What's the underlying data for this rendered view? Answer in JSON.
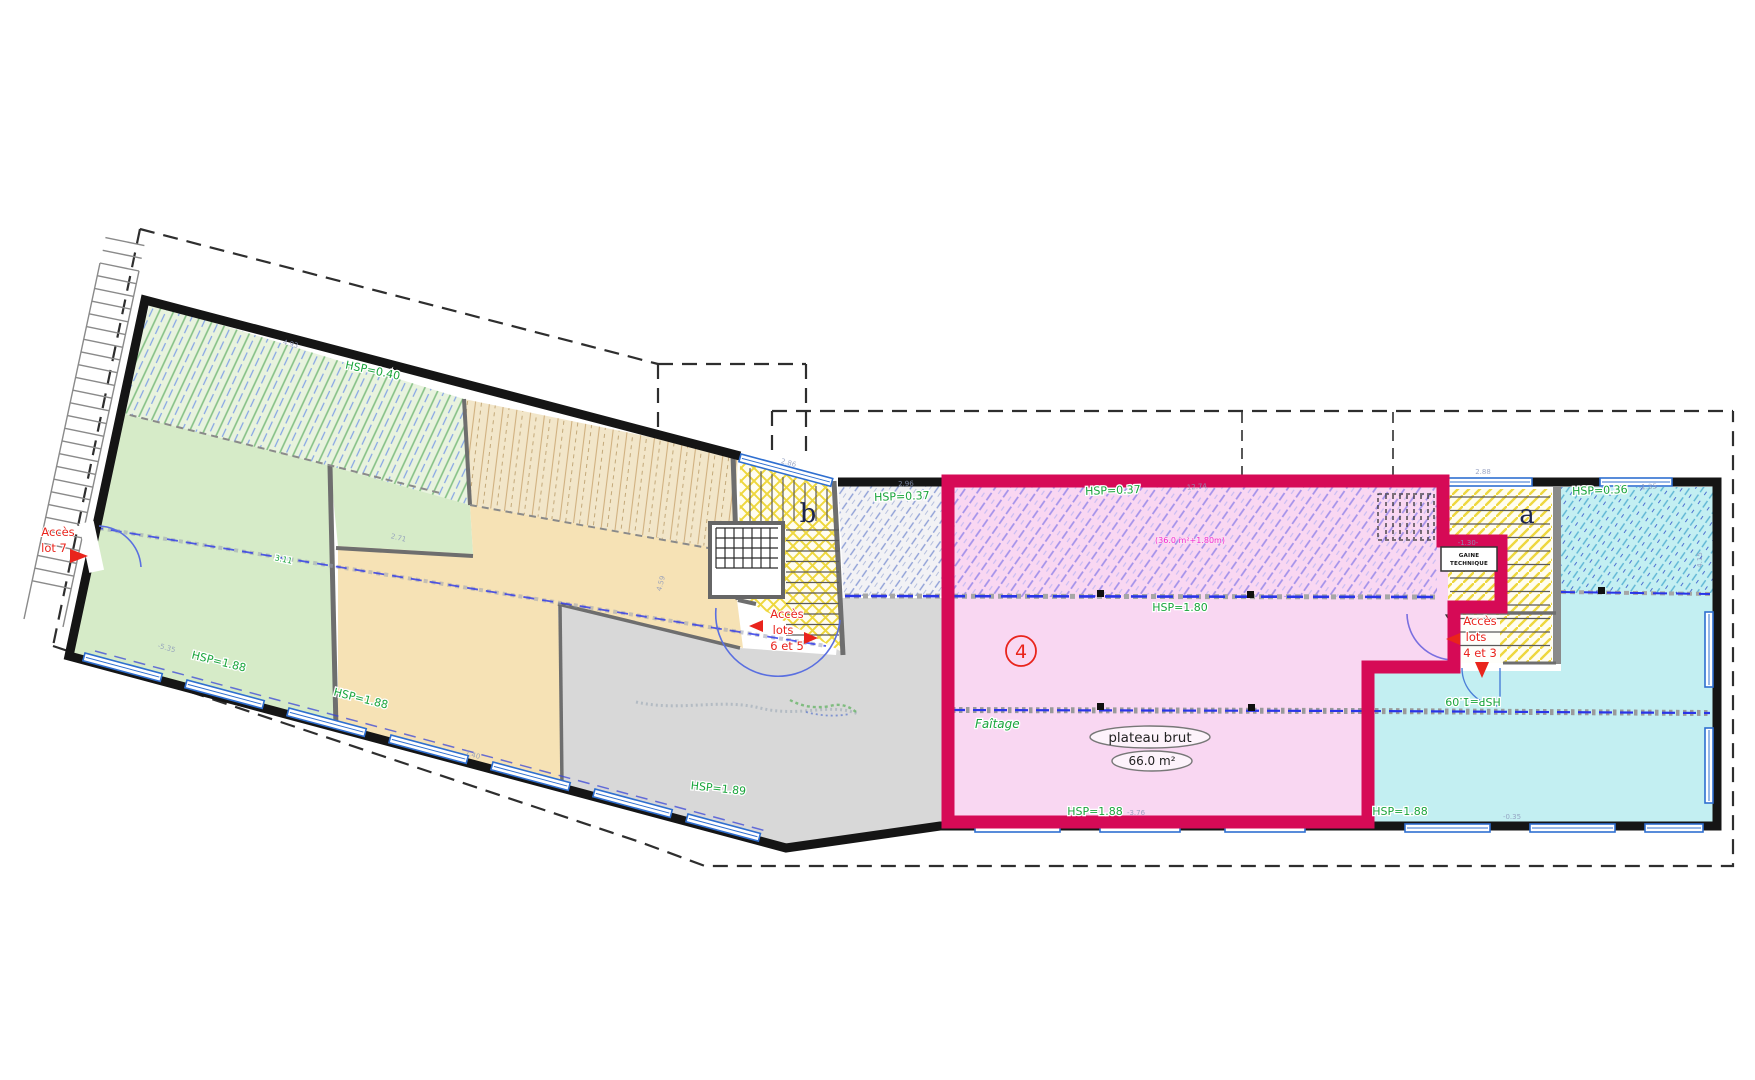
{
  "access": {
    "lot7": [
      "Accès",
      "lot 7"
    ],
    "lots_6_5": [
      "Accès",
      "lots",
      "6 et 5"
    ],
    "lots_4_3": [
      "Accès",
      "lots",
      "4 et 3"
    ]
  },
  "heights": {
    "h040": "HSP=0.40",
    "h037_left": "HSP=0.37",
    "h037_pink": "HSP=0.37",
    "h180": "HSP=1.80",
    "h188_green": "HSP=1.88",
    "h188_orange": "HSP=1.88",
    "h189_gray": "HSP=1.89",
    "h188_pink": "HSP=1.88",
    "h188_cyan": "HSP=1.88",
    "h036": "HSP=0.36",
    "h109": "HSP=1.09"
  },
  "annotations": {
    "faitage": "Faîtage",
    "area_note": "(36.0 m²+1.80m)",
    "plateau": "plateau brut",
    "area": "66.0 m²",
    "lot_number": "4",
    "stair_a": "a",
    "stair_b": "b",
    "gaine": [
      "GAINE",
      "TECHNIQUE"
    ],
    "level_311": "3.11"
  },
  "dims": [
    {
      "t": "4.93",
      "x": 290,
      "y": 346,
      "r": 15
    },
    {
      "t": "2.71",
      "x": 398,
      "y": 540,
      "r": 14
    },
    {
      "t": "-5.35",
      "x": 166,
      "y": 650,
      "r": 15
    },
    {
      "t": "7.40",
      "x": 472,
      "y": 757,
      "r": 15
    },
    {
      "t": "4.59",
      "x": 663,
      "y": 584,
      "r": -75
    },
    {
      "t": "2.86",
      "x": 788,
      "y": 465,
      "r": 15
    },
    {
      "t": "2.96",
      "x": 906,
      "y": 486,
      "r": -2
    },
    {
      "t": "12.74",
      "x": 1197,
      "y": 489,
      "r": -4
    },
    {
      "t": "2.88",
      "x": 1483,
      "y": 474,
      "r": 0
    },
    {
      "t": "-1.35",
      "x": 1648,
      "y": 489,
      "r": -3
    },
    {
      "t": "-1.30-",
      "x": 1468,
      "y": 545,
      "r": 0
    },
    {
      "t": "4.15",
      "x": 1702,
      "y": 560,
      "r": -90
    },
    {
      "t": "-3.76",
      "x": 1136,
      "y": 815,
      "r": 0
    },
    {
      "t": "-0.35",
      "x": 1512,
      "y": 819,
      "r": 0
    }
  ],
  "colors": {
    "lot_border": "#d60a56",
    "height_label_green": "#1aa53c",
    "access_red": "#e9241c",
    "area_magenta": "#f32bd1"
  }
}
